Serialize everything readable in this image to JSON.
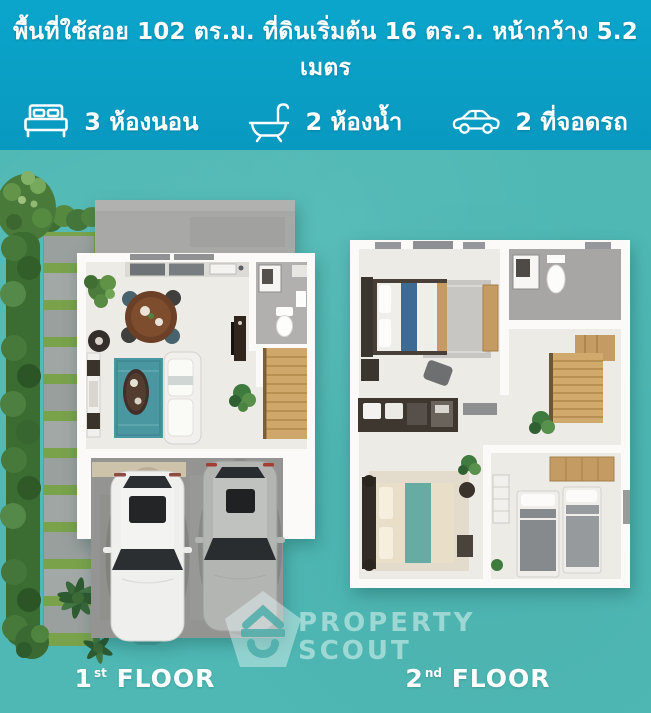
{
  "header": {
    "title": "พื้นที่ใช้สอย 102 ตร.ม. ที่ดินเริ่มต้น 16 ตร.ว. หน้ากว้าง 5.2 เมตร",
    "features": [
      {
        "icon": "bed-icon",
        "label": "3 ห้องนอน"
      },
      {
        "icon": "bathtub-icon",
        "label": "2 ห้องน้ำ"
      },
      {
        "icon": "car-icon",
        "label": "2 ที่จอดรถ"
      }
    ]
  },
  "floor_plans": [
    {
      "label": {
        "number": "1",
        "ordinal": "st",
        "word": "FLOOR"
      }
    },
    {
      "label": {
        "number": "2",
        "ordinal": "nd",
        "word": "FLOOR"
      }
    }
  ],
  "watermark": {
    "line1": "PROPERTY",
    "line2": "SCOUT"
  },
  "colors": {
    "header_background": "#0aa0c6",
    "page_background": "#4fb8b4",
    "text": "#ffffff",
    "watermark": "#9ed8d2"
  }
}
